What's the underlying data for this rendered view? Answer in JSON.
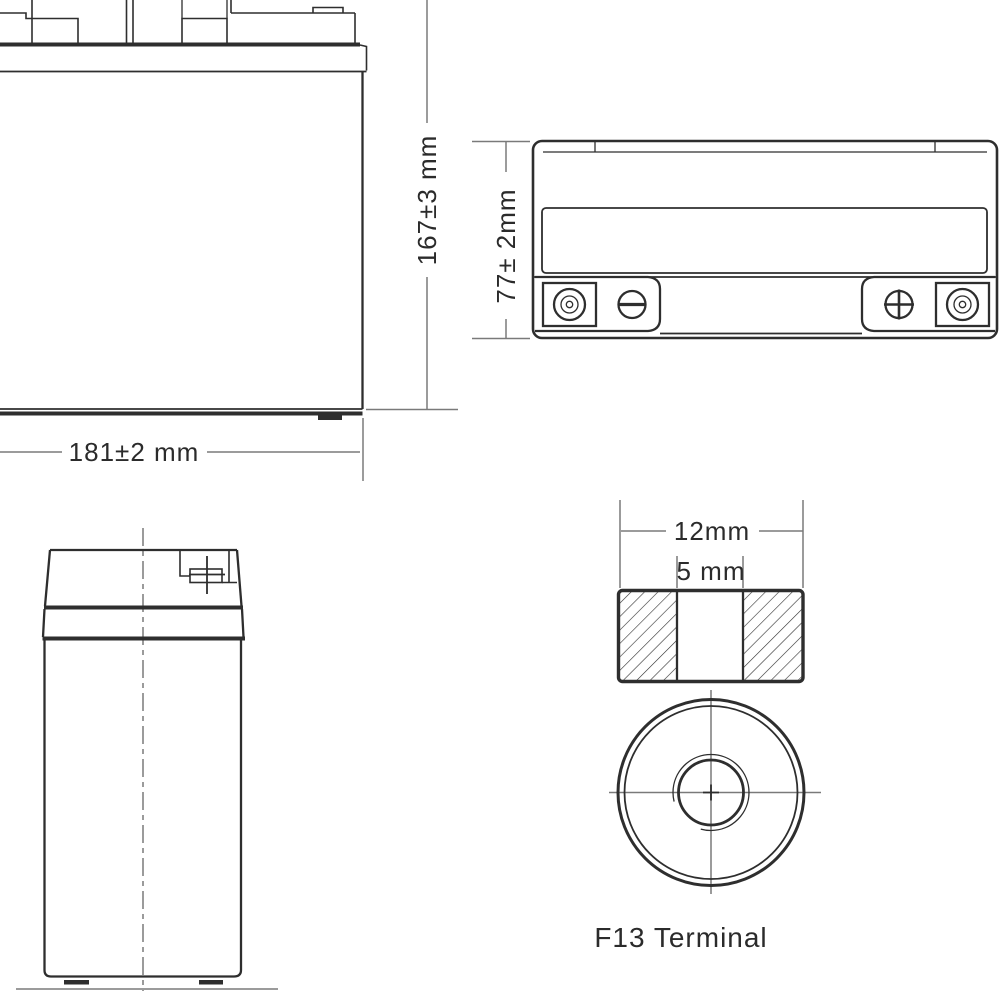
{
  "views": {
    "front": {
      "width_label": "181±2 mm",
      "height_label": "167±3 mm"
    },
    "top": {
      "depth_label": "77± 2mm"
    },
    "terminal_detail": {
      "outer_width_label": "12mm",
      "hole_width_label": "5 mm",
      "title_label": "F13 Terminal"
    }
  },
  "colors": {
    "line": "#2e2e2e",
    "dim_line": "#7a7a7a",
    "text": "#2b2b2b",
    "background": "#ffffff"
  }
}
